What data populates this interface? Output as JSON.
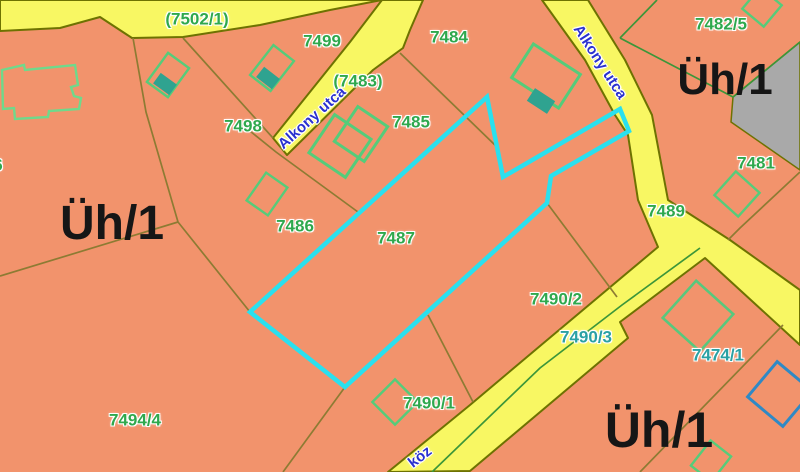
{
  "map": {
    "type": "cadastral-parcel-map",
    "selected_parcel": "7487",
    "colors": {
      "parcel_fill": "#f2936c",
      "road_fill": "#f8f763",
      "road_border": "#6e7201",
      "boundary_line": "#8d7b33",
      "green_line": "#3c9639",
      "gray_fill": "#a9a9a9",
      "building_outline": "#55cc7a",
      "building_fill_teal": "#2fa390",
      "building_outline_blue": "#2f89c5",
      "highlight": "#2ae0ee",
      "label_green": "#2fa84d",
      "label_teal": "#2aa1a4",
      "label_blue": "#2a31cf"
    },
    "parcel_labels": [
      {
        "text": "(7502/1)"
      },
      {
        "text": "7499"
      },
      {
        "text": "7484"
      },
      {
        "text": "(7483)"
      },
      {
        "text": "7498"
      },
      {
        "text": "7485"
      },
      {
        "text": "7482/5"
      },
      {
        "text": "7481"
      },
      {
        "text": "7486"
      },
      {
        "text": "7487"
      },
      {
        "text": "7489"
      },
      {
        "text": "7490/2"
      },
      {
        "text": "7490/3"
      },
      {
        "text": "7474/1"
      },
      {
        "text": "7490/1"
      },
      {
        "text": "7494/4"
      },
      {
        "text": "6"
      }
    ],
    "zone_labels": [
      {
        "text": "Üh/1"
      },
      {
        "text": "Üh/1"
      },
      {
        "text": "Üh/1"
      }
    ],
    "street_labels": [
      {
        "text": "Alkony utca"
      },
      {
        "text": "Alkony utca"
      },
      {
        "text": "köz"
      }
    ]
  }
}
